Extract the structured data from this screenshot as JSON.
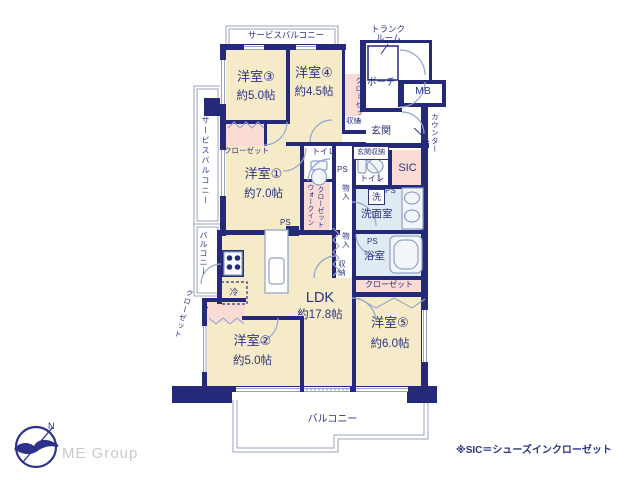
{
  "rooms": {
    "y1": {
      "name": "洋室①",
      "size": "約7.0帖"
    },
    "y2": {
      "name": "洋室②",
      "size": "約5.0帖"
    },
    "y3": {
      "name": "洋室③",
      "size": "約5.0帖"
    },
    "y4": {
      "name": "洋室④",
      "size": "約4.5帖"
    },
    "y5": {
      "name": "洋室⑤",
      "size": "約6.0帖"
    },
    "ldk": {
      "name": "LDK",
      "size": "約17.8帖"
    }
  },
  "labels": {
    "service_balcony": "サービスバルコニー",
    "balcony": "バルコニー",
    "trunk_line1": "トランク",
    "trunk_line2": "ルーム",
    "porch": "ポーチ",
    "mb": "MB",
    "entrance": "玄関",
    "counter": "カウンター",
    "entrance_storage": "玄関収納",
    "sic": "SIC",
    "toilet": "トイレ",
    "washer": "洗",
    "washroom": "洗面室",
    "bathroom": "浴室",
    "ps": "PS",
    "monoire": "物入",
    "shuno": "収納",
    "closet": "クローゼット",
    "wic_line1": "ウォークイン",
    "wic_line2": "クローゼット",
    "fridge": "冷"
  },
  "colors": {
    "wall": "#242a79",
    "room_beige": "#f6ebc8",
    "closet_pink": "#fadcd4",
    "wet_blue": "#e0eaf2",
    "text_navy": "#2b3381"
  },
  "footer": {
    "logo": "ME Group",
    "logo_n": "N",
    "note": "※SIC＝シューズインクローゼット"
  }
}
